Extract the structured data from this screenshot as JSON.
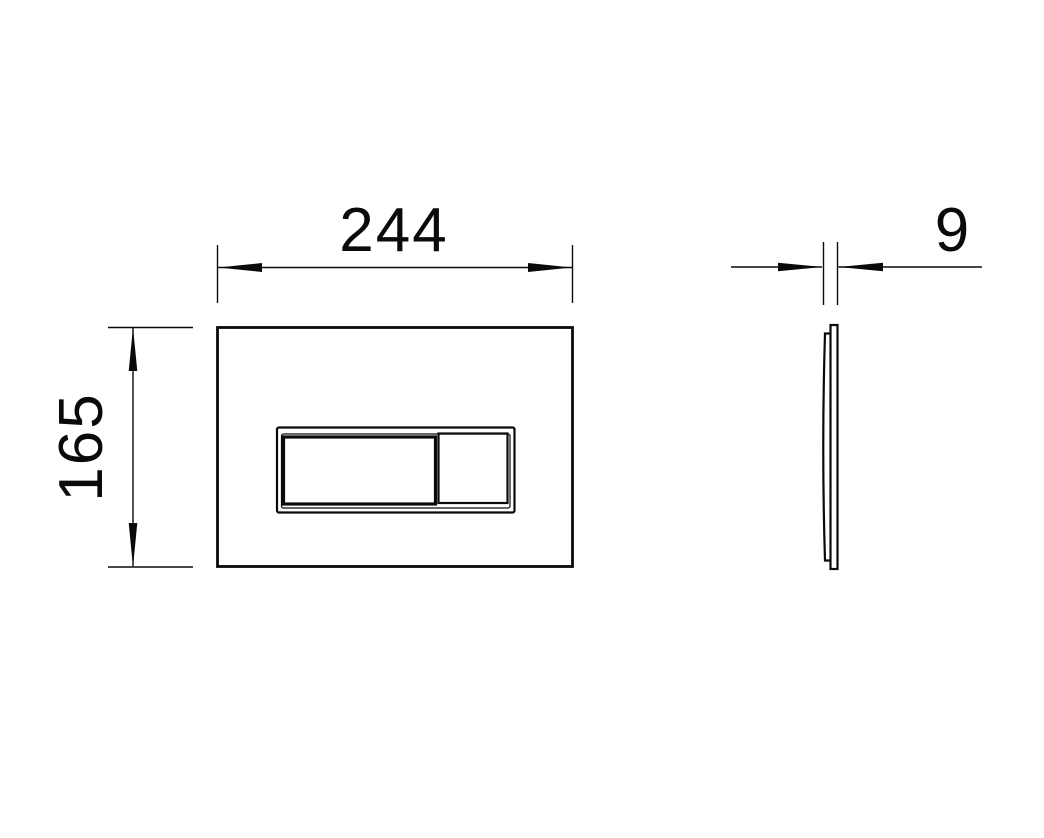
{
  "drawing": {
    "background_color": "#ffffff",
    "line_color": "#0a0a0a",
    "views": {
      "front_view": "flush-plate front elevation with two-section flush button",
      "side_view": "flush-plate side profile"
    },
    "dimensions": {
      "width": "244",
      "height": "165",
      "thickness": "9"
    }
  }
}
